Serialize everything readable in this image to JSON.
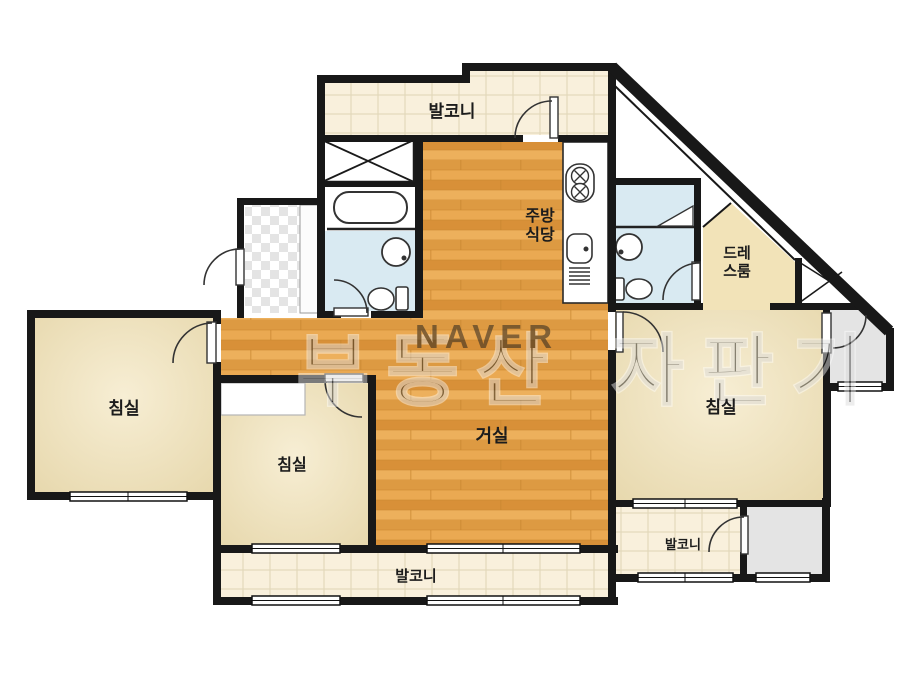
{
  "rooms": {
    "balcony_top": {
      "label": "발코니"
    },
    "kitchen_dining": {
      "label_line1": "주방",
      "label_line2": "식당"
    },
    "dressing_room": {
      "label_line1": "드레",
      "label_line2": "스룸"
    },
    "bedroom_left": {
      "label": "침실"
    },
    "bedroom_middle": {
      "label": "침실"
    },
    "bedroom_right": {
      "label": "침실"
    },
    "living_room": {
      "label": "거실"
    },
    "balcony_bottom": {
      "label": "발코니"
    },
    "balcony_right": {
      "label": "발코니"
    }
  },
  "watermark": {
    "text_left": "부동산",
    "text_right": "자판기",
    "brand": "NAVER"
  },
  "colors": {
    "wall": "#181818",
    "wood_floor": "#e2a04b",
    "bedroom_floor": "#eee0b9",
    "dressing_floor": "#f2e3b8",
    "balcony_tile": "#f9f0dc",
    "bathroom_floor": "#d9eaf2",
    "utility_gray": "#e4e4e4"
  }
}
